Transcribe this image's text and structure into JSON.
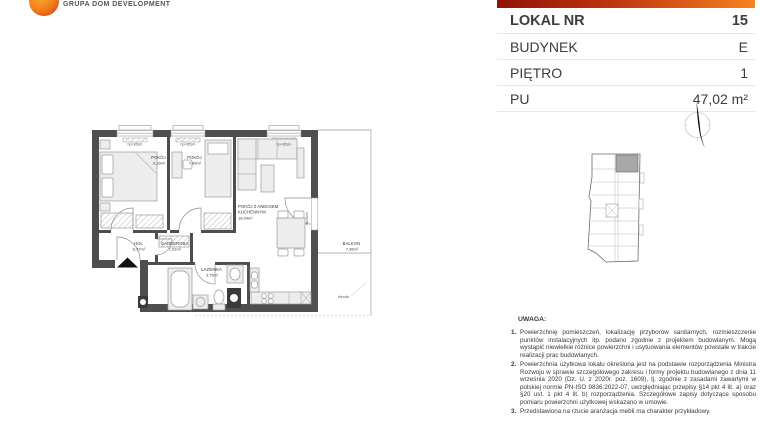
{
  "brand": {
    "name": "GRUPA DOM DEVELOPMENT"
  },
  "unit_card": {
    "rows": [
      {
        "label": "LOKAL NR",
        "value": "15"
      },
      {
        "label": "BUDYNEK",
        "value": "E"
      },
      {
        "label": "PIĘTRO",
        "value": "1"
      },
      {
        "label": "PU",
        "value": "47,02 m²"
      }
    ]
  },
  "floor_plan": {
    "rooms": [
      {
        "name": "POKÓJ",
        "area": "9,16m²"
      },
      {
        "name": "POKÓJ",
        "area": "7,89m²"
      },
      {
        "name": "POKÓJ Z ANEKSEM KUCHENNYM",
        "name_lines": [
          "POKÓJ Z ANEKSEM",
          "KUCHENNYM"
        ],
        "area": "18,34m²"
      },
      {
        "name": "HOL",
        "area": "6,37m²"
      },
      {
        "name": "GARDEROBA",
        "area": "1,51m²"
      },
      {
        "name": "ŁAZIENKA",
        "area": "3,75m²"
      },
      {
        "name": "BALKON",
        "area": "7,36m²"
      }
    ],
    "annotations": {
      "window_sill": "hp=85cm",
      "balcony_door_sill": "hp=0cm",
      "blenda": "blenda"
    }
  },
  "notes": {
    "heading": "UWAGA:",
    "items": [
      {
        "num": "1.",
        "text": "Powierzchnię pomieszczeń, lokalizację przyborów sanitarnych, rozmieszczenie punktów instalacyjnych itp. podano zgodnie z projektem budowlanym. Mogą wystąpić niewielkie różnice powierzchni i usytuowania elementów powstałe w trakcie realizacji prac budowlanych."
      },
      {
        "num": "2.",
        "text": "Powierzchnia użytkowa lokalu określona jest na podstawie rozporządzenia Ministra Rozwoju w sprawie szczegółowego zakresu i formy projektu budowlanego z dnia 11 września 2020 (Dz. U. z 2020r. poz. 1609), tj. zgodnie z zasadami zawartymi w polskiej normie PN-ISO 9836:2022-07, uwzględniając przepisy §14 pkt 4 lit. a) oraz §20 ust. 1 pkt 4 lit. b) rozporządzenia. Szczegółowe zapisy dotyczące sposobu pomiaru powierzchni użytkowej wskazano w umowie."
      },
      {
        "num": "3.",
        "text": "Przedstawiona na rzucie aranżacja mebli ma charakter przykładowy."
      }
    ]
  },
  "colors": {
    "header_bar_left": "#8f1408",
    "header_bar_right": "#f58220",
    "logo_orange": "#ef7d1a",
    "plan_wall": "#4e4e4e",
    "site_highlight": "#a8a8a8"
  }
}
